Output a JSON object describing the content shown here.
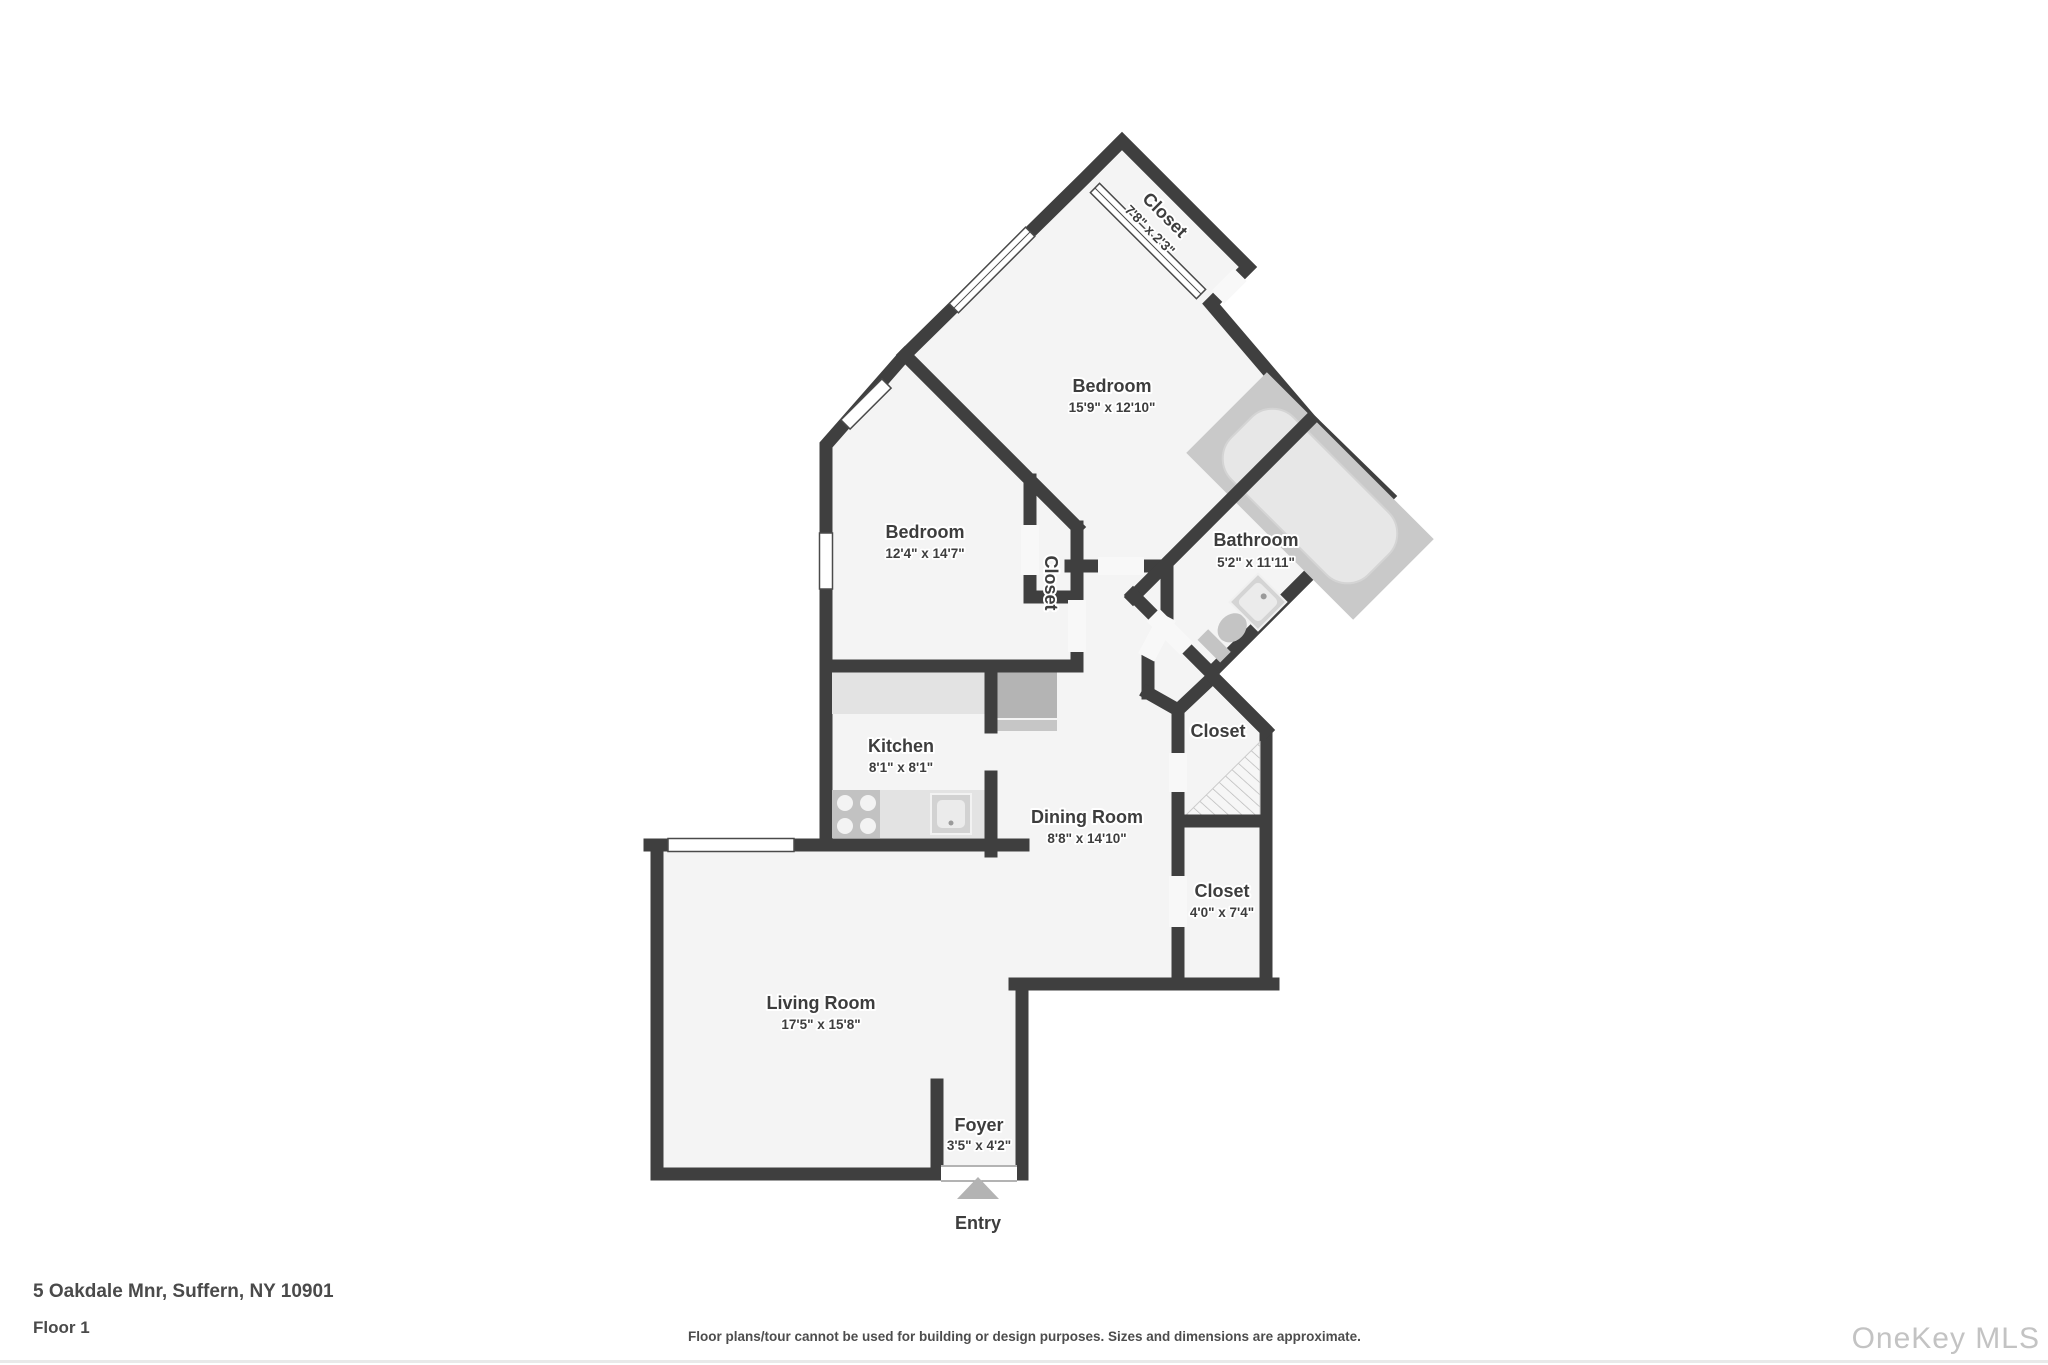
{
  "address": "5 Oakdale Mnr, Suffern, NY 10901",
  "floor_label": "Floor 1",
  "disclaimer": "Floor plans/tour cannot be used for building or design purposes. Sizes and dimensions are approximate.",
  "watermark": "OneKey MLS",
  "entry_label": "Entry",
  "colors": {
    "wall": "#3f3f3f",
    "floor": "#f4f4f4",
    "bathroom_floor": "#c9c9c9",
    "counter": "#e3e3e3",
    "appliance": "#b4b4b4",
    "entry_arrow": "#b3b3b3",
    "watermark": "#c3c3c3"
  },
  "rooms": {
    "bedroom1": {
      "name": "Bedroom",
      "dims": "15'9\" x 12'10\""
    },
    "bedroom2": {
      "name": "Bedroom",
      "dims": "12'4\" x 14'7\""
    },
    "bathroom": {
      "name": "Bathroom",
      "dims": "5'2\" x 11'11\""
    },
    "closet_top": {
      "name": "Closet",
      "dims": "7'8\" x 2'3\""
    },
    "closet_side": {
      "name": "Closet",
      "dims": ""
    },
    "closet_mid": {
      "name": "Closet",
      "dims": ""
    },
    "closet_lower": {
      "name": "Closet",
      "dims": "4'0\" x 7'4\""
    },
    "kitchen": {
      "name": "Kitchen",
      "dims": "8'1\" x 8'1\""
    },
    "dining": {
      "name": "Dining Room",
      "dims": "8'8\" x 14'10\""
    },
    "living": {
      "name": "Living Room",
      "dims": "17'5\" x 15'8\""
    },
    "foyer": {
      "name": "Foyer",
      "dims": "3'5\" x 4'2\""
    }
  }
}
